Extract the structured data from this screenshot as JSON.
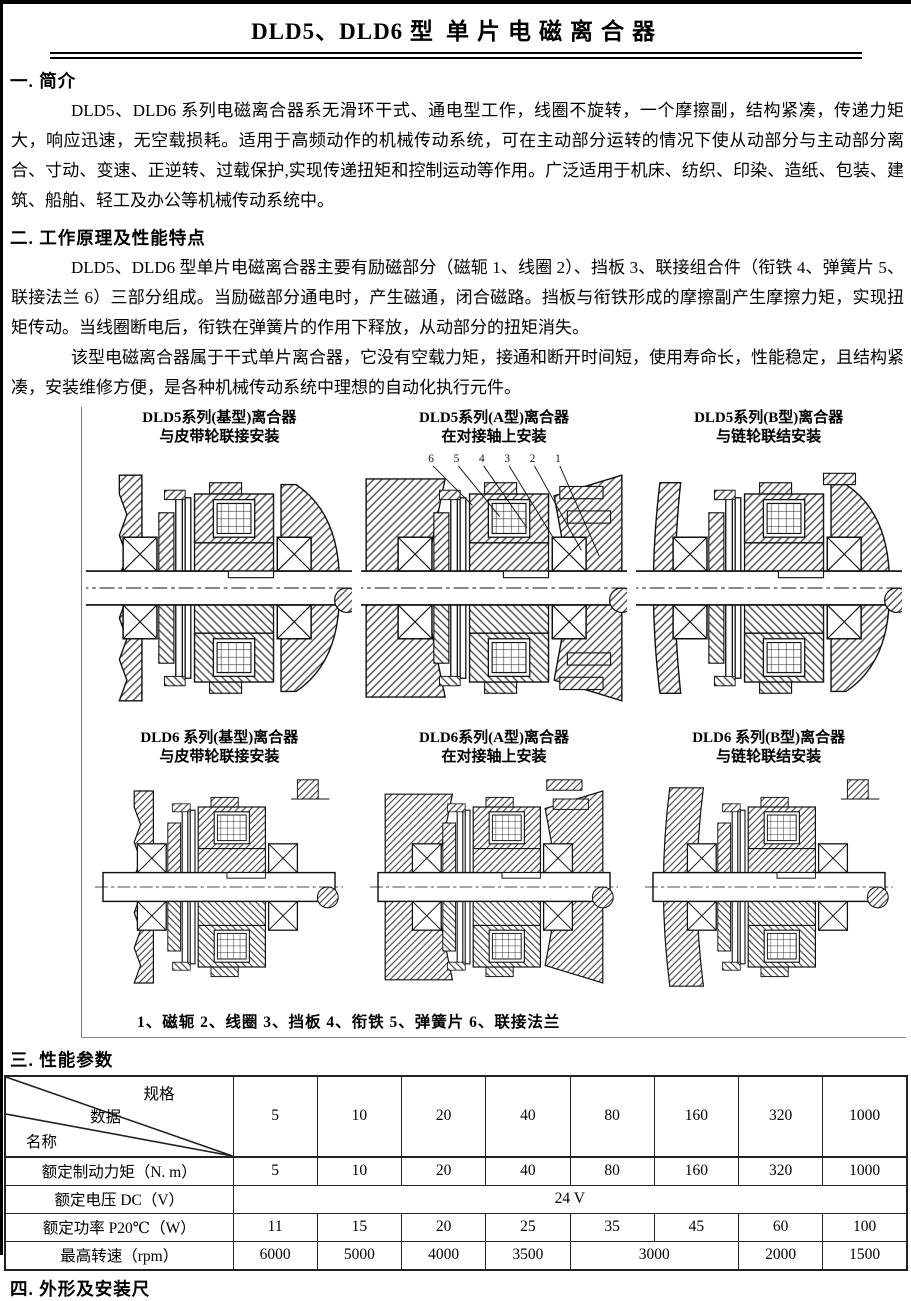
{
  "page": {
    "title_left": "DLD5、DLD6 型",
    "title_right": "单片电磁离合器"
  },
  "sections": {
    "s1": {
      "heading": "一. 简介",
      "p1": "DLD5、DLD6 系列电磁离合器系无滑环干式、通电型工作，线圈不旋转，一个摩擦副，结构紧凑，传递力矩大，响应迅速，无空载损耗。适用于高频动作的机械传动系统，可在主动部分运转的情况下使从动部分与主动部分离合、寸动、变速、正逆转、过载保护,实现传递扭矩和控制运动等作用。广泛适用于机床、纺织、印染、造纸、包装、建筑、船舶、轻工及办公等机械传动系统中。"
    },
    "s2": {
      "heading": "二. 工作原理及性能特点",
      "p1": "DLD5、DLD6 型单片电磁离合器主要有励磁部分（磁轭 1、线圈 2）、挡板 3、联接组合件（衔铁 4、弹簧片 5、联接法兰 6）三部分组成。当励磁部分通电时，产生磁通，闭合磁路。挡板与衔铁形成的摩擦副产生摩擦力矩，实现扭矩传动。当线圈断电后，衔铁在弹簧片的作用下释放，从动部分的扭矩消失。",
      "p2": "该型电磁离合器属于干式单片离合器，它没有空载力矩，接通和断开时间短，使用寿命长，性能稳定，且结构紧凑，安装维修方便，是各种机械传动系统中理想的自动化执行元件。"
    },
    "s3": {
      "heading": "三. 性能参数"
    },
    "s4": {
      "heading": "四. 外形及安装尺"
    }
  },
  "figures": {
    "captions": [
      {
        "l1": "DLD5系列(基型)离合器",
        "l2": "与皮带轮联接安装"
      },
      {
        "l1": "DLD5系列(A型)离合器",
        "l2": "在对接轴上安装"
      },
      {
        "l1": "DLD5系列(B型)离合器",
        "l2": "与链轮联结安装"
      },
      {
        "l1": "DLD6 系列(基型)离合器",
        "l2": "与皮带轮联接安装"
      },
      {
        "l1": "DLD6系列(A型)离合器",
        "l2": "在对接轴上安装"
      },
      {
        "l1": "DLD6 系列(B型)离合器",
        "l2": "与链轮联结安装"
      }
    ],
    "leader_numbers": [
      "6",
      "5",
      "4",
      "3",
      "2",
      "1"
    ],
    "parts_caption": "1、磁轭  2、线圈  3、挡板  4、衔铁  5、弹簧片  6、联接法兰"
  },
  "table": {
    "corner": {
      "top": "规格",
      "mid": "数据",
      "bottom": "名称"
    },
    "columns": [
      "5",
      "10",
      "20",
      "40",
      "80",
      "160",
      "320",
      "1000"
    ],
    "rows": [
      {
        "label": "额定制动力矩（N. m）",
        "cells": [
          "5",
          "10",
          "20",
          "40",
          "80",
          "160",
          "320",
          "1000"
        ]
      },
      {
        "label": "额定电压 DC（V）",
        "value": "24 V"
      },
      {
        "label": "额定功率 P20℃（W）",
        "cells": [
          "11",
          "15",
          "20",
          "25",
          "35",
          "45",
          "60",
          "100"
        ]
      },
      {
        "label": "最高转速（rpm）",
        "cells": [
          "6000",
          "5000",
          "4000",
          "3500",
          "3000",
          "2000",
          "1500"
        ]
      }
    ]
  }
}
